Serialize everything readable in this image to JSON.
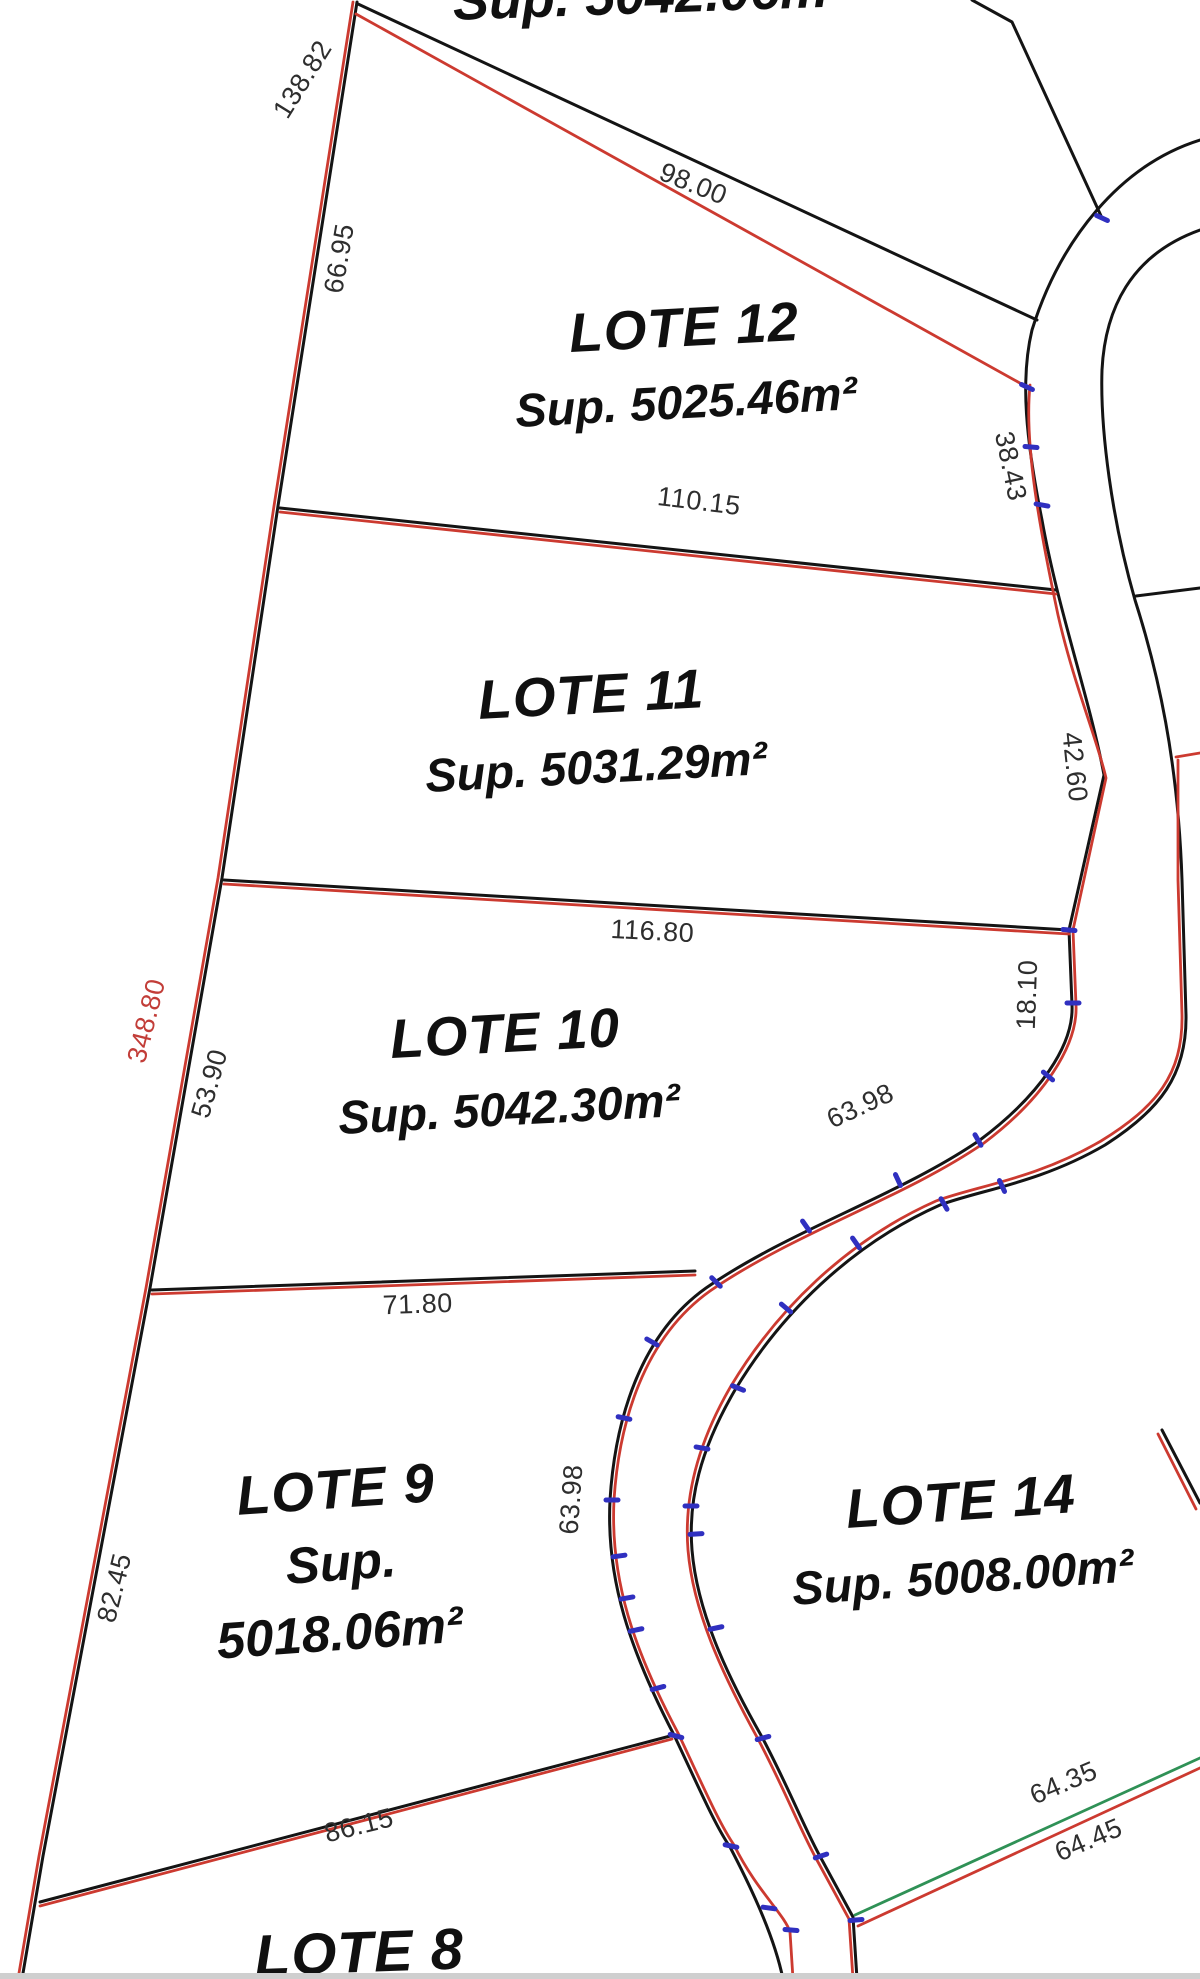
{
  "map": {
    "top_clipped_area_label": "Sup. 5042.06m²",
    "lots": {
      "l12": {
        "name": "LOTE 12",
        "area": "Sup. 5025.46m²"
      },
      "l11": {
        "name": "LOTE 11",
        "area": "Sup. 5031.29m²"
      },
      "l10": {
        "name": "LOTE 10",
        "area": "Sup. 5042.30m²"
      },
      "l9": {
        "name": "LOTE 9",
        "sup": "Sup.",
        "area": "5018.06m²"
      },
      "l14": {
        "name": "LOTE 14",
        "area": "Sup. 5008.00m²"
      },
      "l8": {
        "name": "LOTE 8"
      }
    },
    "dims": {
      "left_top": "138.82",
      "left_upper": "66.95",
      "north_red": "98.00",
      "lot12_south": "110.15",
      "road_curve_upper": "38.43",
      "road_mid": "42.60",
      "lot11_south": "116.80",
      "lot10_frontage": "18.10",
      "left_total_red": "348.80",
      "left_mid": "53.90",
      "curve_lot10": "63.98",
      "lot10_south": "71.80",
      "left_lower": "82.45",
      "curve_lot9": "63.98",
      "lot9_south": "86.15",
      "green_line": "64.35",
      "red_line": "64.45"
    },
    "colors": {
      "boundary_black": "#141414",
      "overlay_red": "#cc3a30",
      "overlay_green": "#2f9156",
      "tick_blue": "#3030c0",
      "dim_red_text": "#c23d38"
    }
  }
}
